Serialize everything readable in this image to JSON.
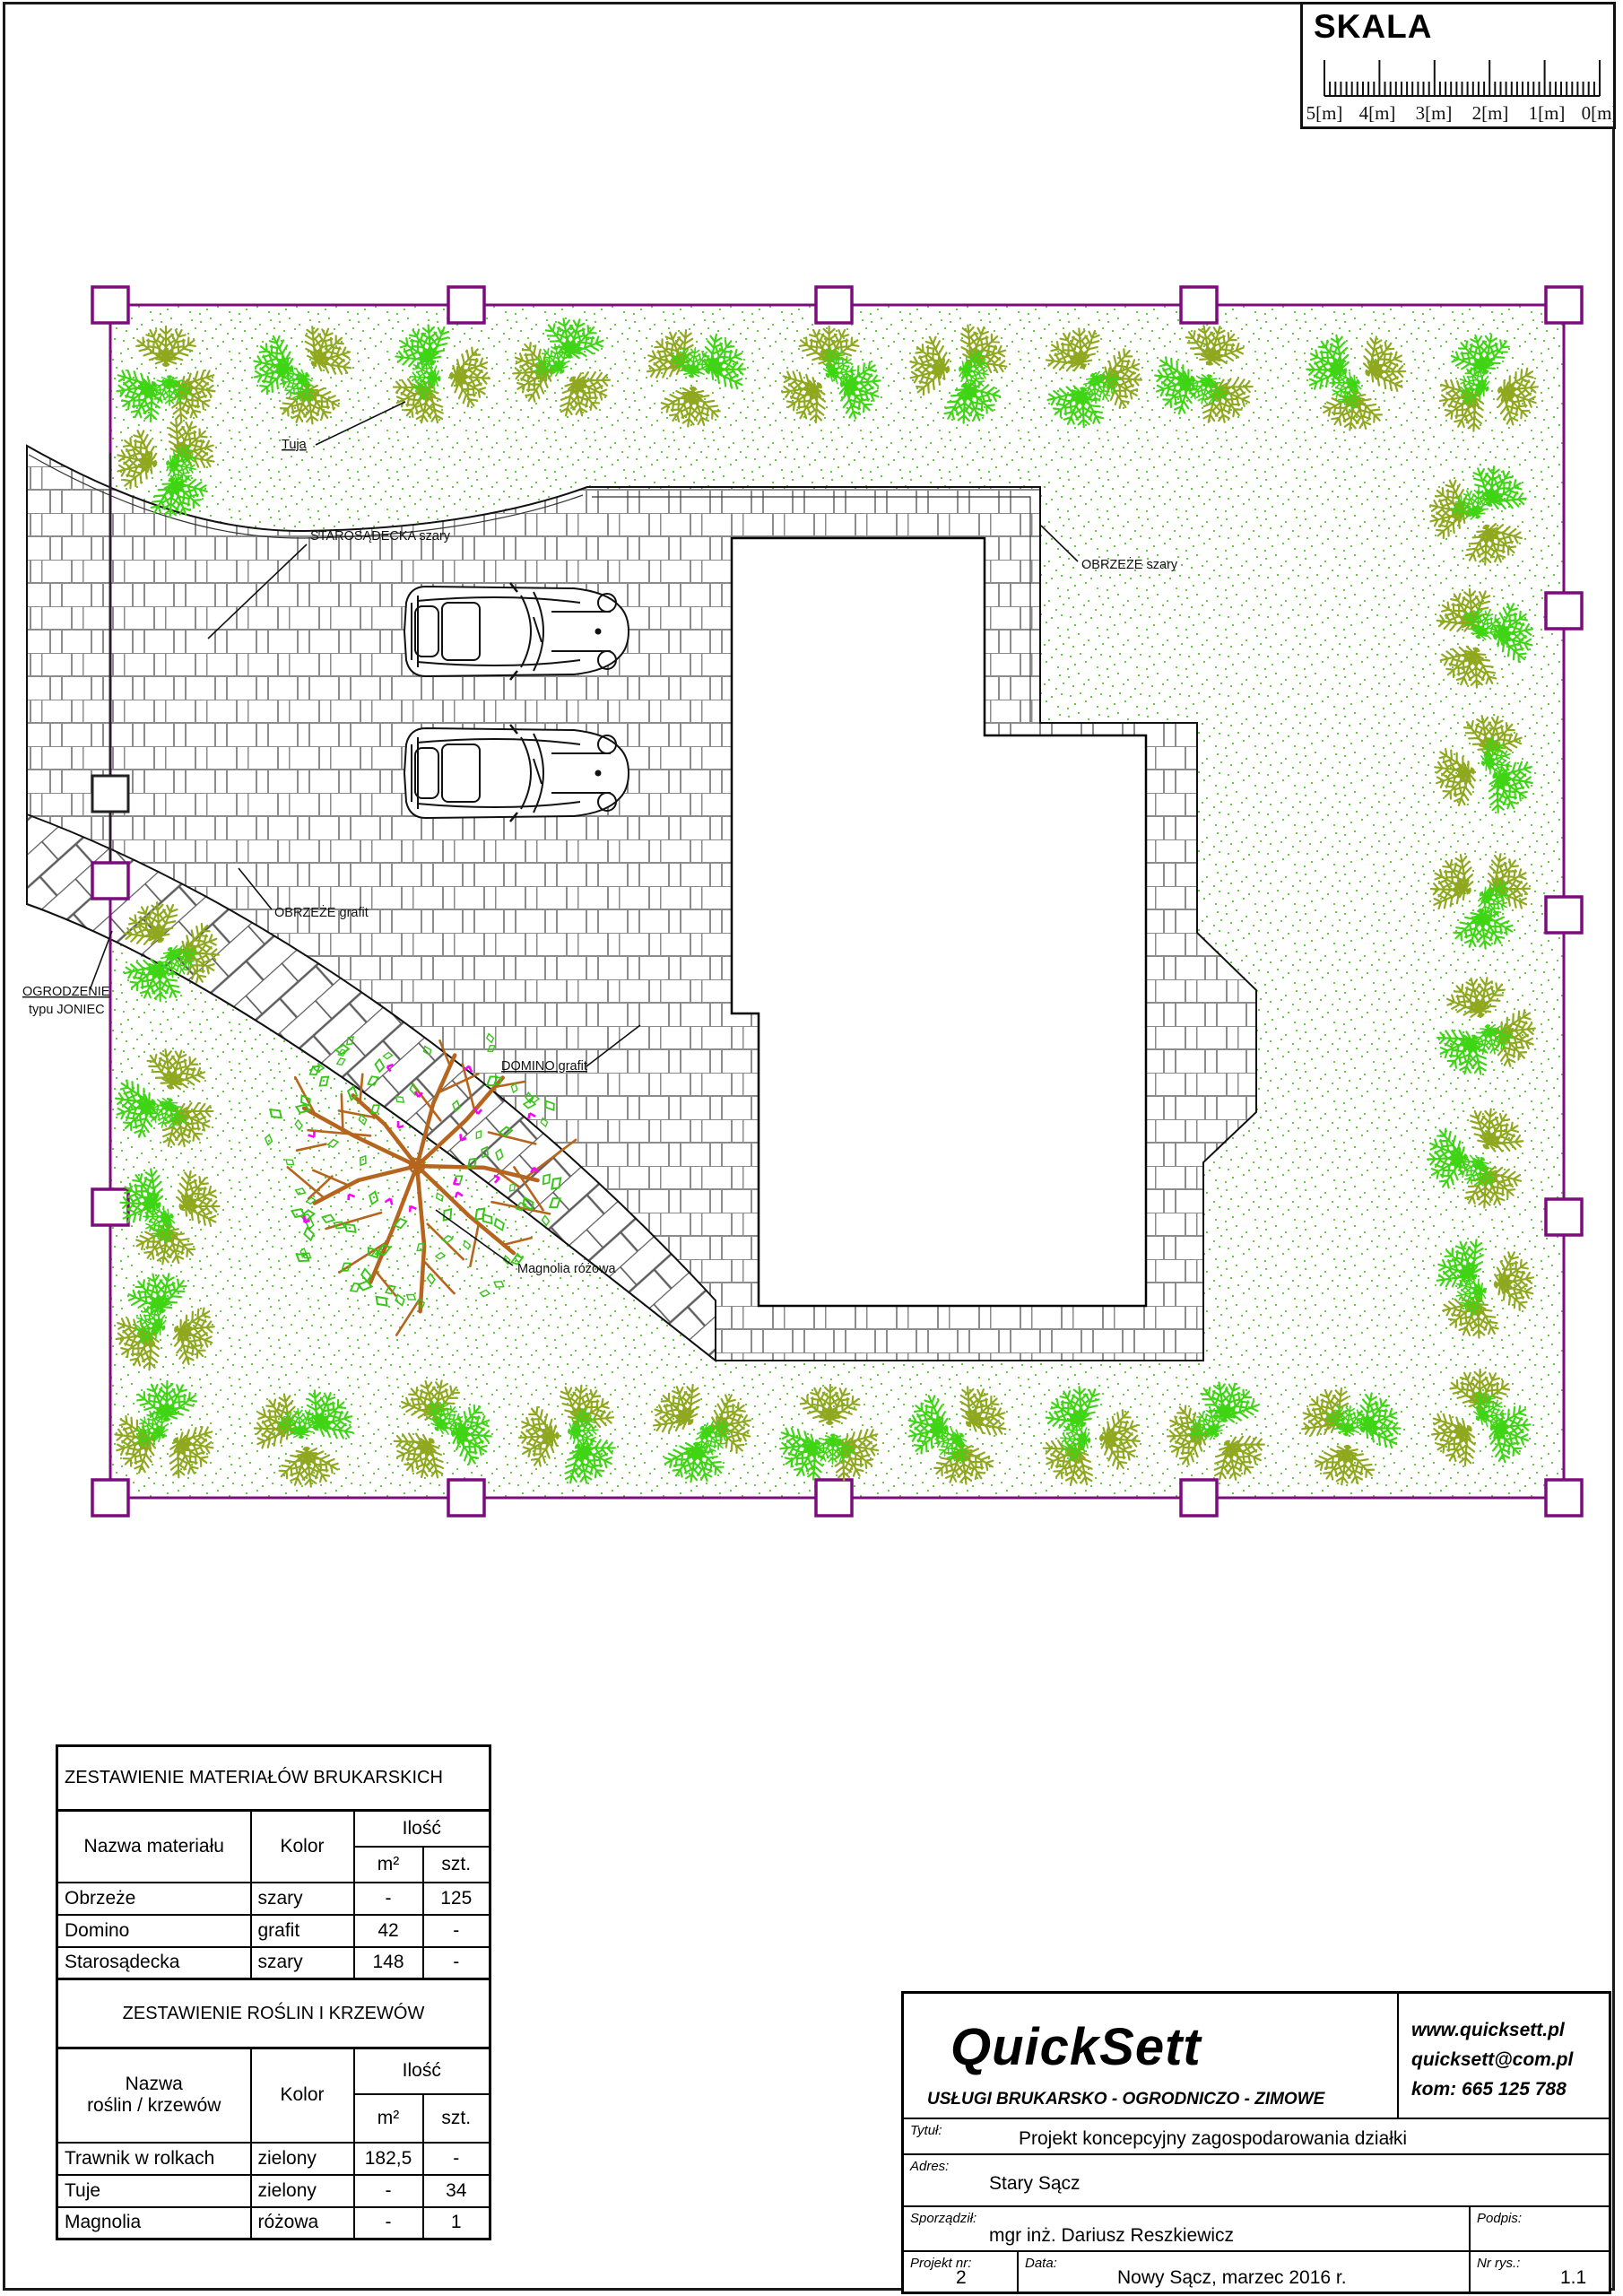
{
  "scale_bar": {
    "title": "SKALA",
    "tick_labels": [
      "5[m]",
      "4[m]",
      "3[m]",
      "2[m]",
      "1[m]",
      "0[m]"
    ]
  },
  "plan": {
    "labels": {
      "tuja": "Tuja",
      "starosadecka": "STAROSĄDECKA szary",
      "obrzeze_szary": "OBRZEŻE szary",
      "obrzeze_grafit": "OBRZEŻE grafit",
      "ogrodzenie_line1": "OGRODZENIE",
      "ogrodzenie_line2": "typu JONIEC",
      "domino": "DOMINO grafit",
      "magnolia": "Magnolia różowa"
    },
    "colors": {
      "fence": "#7D0B7D",
      "shrub_olive": "#8FA81F",
      "shrub_bright": "#3FD414",
      "grass_dot": "#55C62E",
      "brick_line": "#8C8C8C",
      "domino_line": "#5E5E5E",
      "magnolia_branch": "#B5651D",
      "magnolia_leaf": "#39C41A",
      "magnolia_flower": "#FF00FF"
    }
  },
  "materials_table": {
    "title": "ZESTAWIENIE MATERIAŁÓW BRUKARSKICH",
    "headers": {
      "name": "Nazwa materiału",
      "color": "Kolor",
      "qty": "Ilość",
      "m2": "m²",
      "pcs": "szt."
    },
    "rows": [
      {
        "name": "Obrzeże",
        "color": "szary",
        "m2": "-",
        "pcs": "125"
      },
      {
        "name": "Domino",
        "color": "grafit",
        "m2": "42",
        "pcs": "-"
      },
      {
        "name": "Starosądecka",
        "color": "szary",
        "m2": "148",
        "pcs": "-"
      }
    ]
  },
  "plants_table": {
    "title": "ZESTAWIENIE ROŚLIN I KRZEWÓW",
    "headers": {
      "name_line1": "Nazwa",
      "name_line2": "roślin / krzewów",
      "color": "Kolor",
      "qty": "Ilość",
      "m2": "m²",
      "pcs": "szt."
    },
    "rows": [
      {
        "name": "Trawnik w rolkach",
        "color": "zielony",
        "m2": "182,5",
        "pcs": "-"
      },
      {
        "name": "Tuje",
        "color": "zielony",
        "m2": "-",
        "pcs": "34"
      },
      {
        "name": "Magnolia",
        "color": "różowa",
        "m2": "-",
        "pcs": "1"
      }
    ]
  },
  "title_block": {
    "company": "QuickSett",
    "tagline": "USŁUGI BRUKARSKO - OGRODNICZO - ZIMOWE",
    "website": "www.quicksett.pl",
    "email": "quicksett@com.pl",
    "phone": "kom: 665 125 788",
    "tytul_label": "Tytuł:",
    "tytul": "Projekt koncepcyjny zagospodarowania działki",
    "adres_label": "Adres:",
    "adres": "Stary Sącz",
    "sporzadzil_label": "Sporządził:",
    "sporzadzil": "mgr inż. Dariusz Reszkiewicz",
    "podpis_label": "Podpis:",
    "projekt_nr_label": "Projekt nr:",
    "projekt_nr": "2",
    "data_label": "Data:",
    "data": "Nowy Sącz, marzec 2016 r.",
    "nr_rys_label": "Nr rys.:",
    "nr_rys": "1.1"
  }
}
